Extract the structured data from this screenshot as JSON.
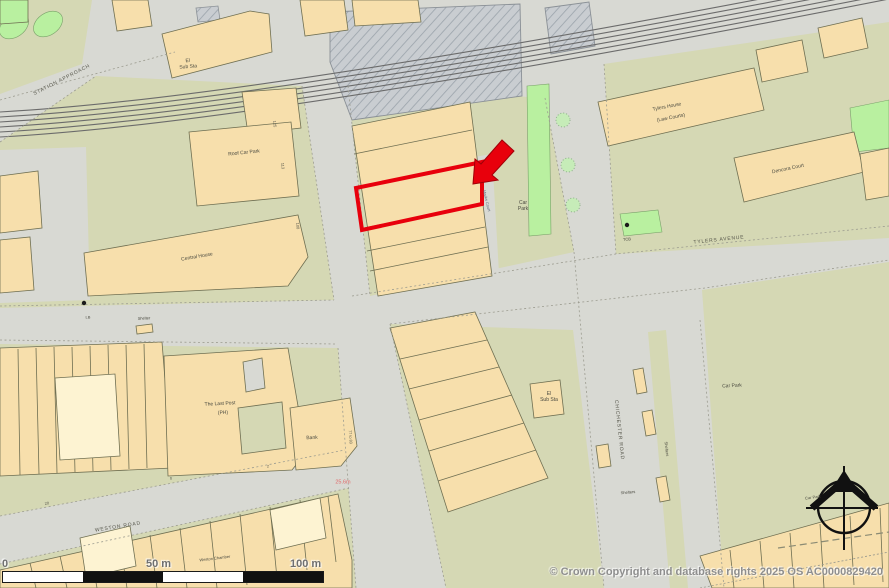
{
  "copyright": "© Crown Copyright and database rights 2025 OS AC0000829420",
  "scale_bar": {
    "zero": "0",
    "mid": "50 m",
    "end": "100 m"
  },
  "labels": {
    "station_approach": "STATION APPROACH",
    "el_sub_sta_top": "El\nSub Sta",
    "roof_car_park": "Roof Car Park",
    "central_house": "Central House",
    "tylers_house": "Tylers House",
    "law_courts": "(Law Courts)",
    "dencora_court": "Dencora Court",
    "tylers_avenue": "TYLERS AVENUE",
    "tcb": "TCB",
    "marks_court": "Marks Court",
    "car_park_mid": "Car\nPark",
    "car_park_se": "Car Park",
    "car_park_corner": "Car Park",
    "chichester_road": "CHICHESTER ROAD",
    "el_sub_sta_mid": "El\nSub Sta",
    "shelters_vertical": "Shelters",
    "shelters_horizontal": "Shelters",
    "lb": "LB",
    "shelter": "Shelter",
    "the_last_post": "The Last Post",
    "ph": "(PH)",
    "bank": "Bank",
    "weston_road": "WESTON ROAD",
    "weston_chamber": "Weston Chamber",
    "spot_height": "25.6m",
    "num_125": "125",
    "num_113": "113",
    "num_108": "108",
    "num_77_83": "77 to 83",
    "num_20": "20",
    "num_6": "6",
    "num_2": "2"
  },
  "colors": {
    "road": "#d8d9d3",
    "building": "#f7dfac",
    "building_pale": "#fdf3d2",
    "khaki_green": "#d5d8b4",
    "bright_green": "#b9f0a0",
    "outline": "#6f6f52",
    "highlight_red": "#e8000c",
    "rail_hatch": "#c9cdd1",
    "spot_red": "#e06a6a"
  }
}
